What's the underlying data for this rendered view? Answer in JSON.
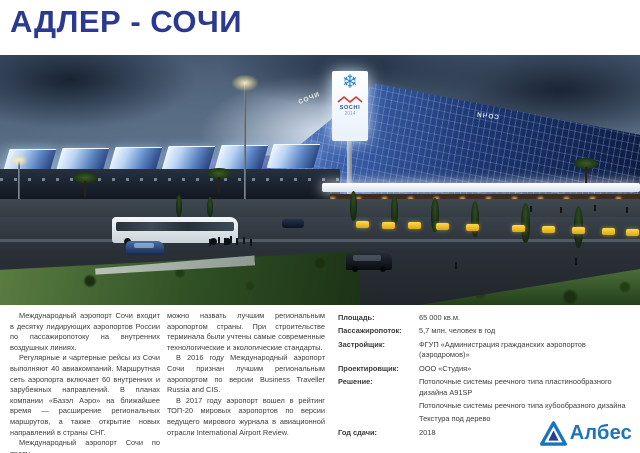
{
  "slide": {
    "title": "АДЛЕР - СОЧИ"
  },
  "photo": {
    "roof_text": "СОЧИ",
    "tower": {
      "snowflake_glyph": "❄",
      "label": "SOCHI",
      "year": "2014"
    }
  },
  "description": {
    "col1_p1": "Международный аэропорт Сочи входит в десятку лидирующих аэропортов России по пассажиропотоку на внутренних воздушных линиях.",
    "col1_p2": "Регулярные и чартерные рейсы из Сочи выполняют 40 авиакомпаний. Маршрутная сеть аэропорта включает 60 внутренних и зарубежных направлений. В планах компании «Базэл Аэро» на ближайшее время — расширение региональных маршрутов, а также открытие новых направлений в страны СНГ.",
    "col1_p3": "Международный аэропорт Сочи по праву",
    "col2_p1": "можно назвать лучшим региональным аэропортом страны. При строительстве терминала были учтены самые современные технологические и экологические стандарты.",
    "col2_p2": "В 2016 году Международный аэропорт Сочи признан лучшим региональным аэропортом по версии Business Traveller Russia and CIS.",
    "col2_p3": "В 2017 году аэропорт вошел в рейтинг ТОП-20 мировых аэропортов по версии ведущего мирового журнала в авиационной отрасли International Airport Review."
  },
  "specs": {
    "rows": [
      {
        "label": "Площадь:",
        "lines": [
          "65 000 кв.м."
        ]
      },
      {
        "label": "Пассажиропоток:",
        "lines": [
          "5,7 млн. человек в год"
        ]
      },
      {
        "label": "Застройщик:",
        "lines": [
          "ФГУП «Администрация гражданских аэропортов (аэродромов)»"
        ]
      },
      {
        "label": "Проектировщик:",
        "lines": [
          "ООО «Студия»"
        ]
      },
      {
        "label": "Решение:",
        "lines": [
          "Потолочные системы реечного типа пластинообразного дизайна A91SP",
          "Потолочные системы реечного типа кубообразного дизайна",
          "Текстура под дерево"
        ]
      },
      {
        "label": "Год сдачи:",
        "lines": [
          "2018"
        ]
      }
    ]
  },
  "footer": {
    "brand": "Албес"
  },
  "colors": {
    "title": "#2b3990",
    "brand": "#1c75bc",
    "text": "#3d3d3d"
  }
}
